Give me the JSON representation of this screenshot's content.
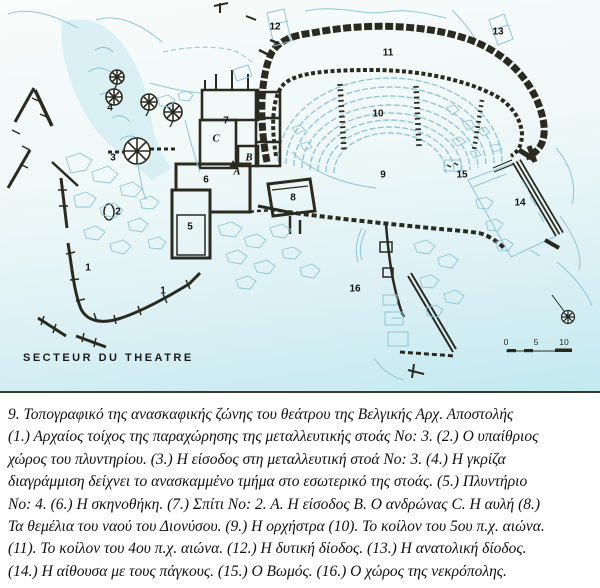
{
  "colors": {
    "ink": "#2b2a1e",
    "blue": "#8fc6d6",
    "seat": "#93c6d6",
    "wash": "#c3e8ef",
    "bg1": "#f8fcfb",
    "bg2": "#c2e9f0",
    "label": "#14130d"
  },
  "map": {
    "secteur_label": "SECTEUR DU THEATRE",
    "north_label": "N",
    "scale": {
      "t0": "0",
      "t5": "5",
      "t10": "10"
    },
    "labels": [
      {
        "text": "1",
        "x": 88,
        "y": 268
      },
      {
        "text": "1",
        "x": 163,
        "y": 291
      },
      {
        "text": "2",
        "x": 118,
        "y": 212
      },
      {
        "text": "3",
        "x": 113,
        "y": 158
      },
      {
        "text": "4",
        "x": 110,
        "y": 108
      },
      {
        "text": "5",
        "x": 190,
        "y": 227
      },
      {
        "text": "6",
        "x": 206,
        "y": 180
      },
      {
        "text": "7",
        "x": 226,
        "y": 121
      },
      {
        "text": "8",
        "x": 293,
        "y": 198
      },
      {
        "text": "9",
        "x": 383,
        "y": 175
      },
      {
        "text": "10",
        "x": 378,
        "y": 114
      },
      {
        "text": "11",
        "x": 388,
        "y": 53
      },
      {
        "text": "12",
        "x": 275,
        "y": 27
      },
      {
        "text": "13",
        "x": 498,
        "y": 32
      },
      {
        "text": "14",
        "x": 520,
        "y": 203
      },
      {
        "text": "15",
        "x": 462,
        "y": 175
      },
      {
        "text": "16",
        "x": 355,
        "y": 289
      },
      {
        "text": "A",
        "x": 237,
        "y": 172,
        "kind": "letter"
      },
      {
        "text": "B",
        "x": 249,
        "y": 158,
        "kind": "letter"
      },
      {
        "text": "C",
        "x": 216,
        "y": 139,
        "kind": "letter"
      }
    ]
  },
  "caption": {
    "lines": [
      "9. Τοπογραφικό της ανασκαφικής ζώνης του θεάτρου της Βελγικής Αρχ. Αποστολής",
      "(1.) Αρχαίος τοίχος της παραχώρησης της μεταλλευτικής στοάς No: 3. (2.) Ο υπαίθριος",
      "χώρος του πλυντηρίου. (3.) Η είσοδος στη μεταλλευτική στοά No: 3. (4.) Η γκρίζα",
      "διαγράμμιση δείχνει το ανασκαμμένο τμήμα στο εσωτερικό της στοάς. (5.) Πλυντήριο",
      "No: 4. (6.) Η σκηνοθήκη. (7.) Σπίτι No: 2. A. Η είσοδος B. Ο ανδρώνας C. Η αυλή (8.)",
      "Τα θεμέλια του ναού του Διονύσου. (9.) Η ορχήστρα (10). Το κοίλον του 5ου π.χ. αιώνα.",
      "(11). Το κοίλον του 4ου π.χ. αιώνα. (12.) Η δυτική δίοδος. (13.) Η ανατολική δίοδος.",
      "(14.) Η αίθουσα με τους πάγκους. (15.) Ο Βωμός. (16.) Ο χώρος της νεκρόπολης."
    ]
  }
}
